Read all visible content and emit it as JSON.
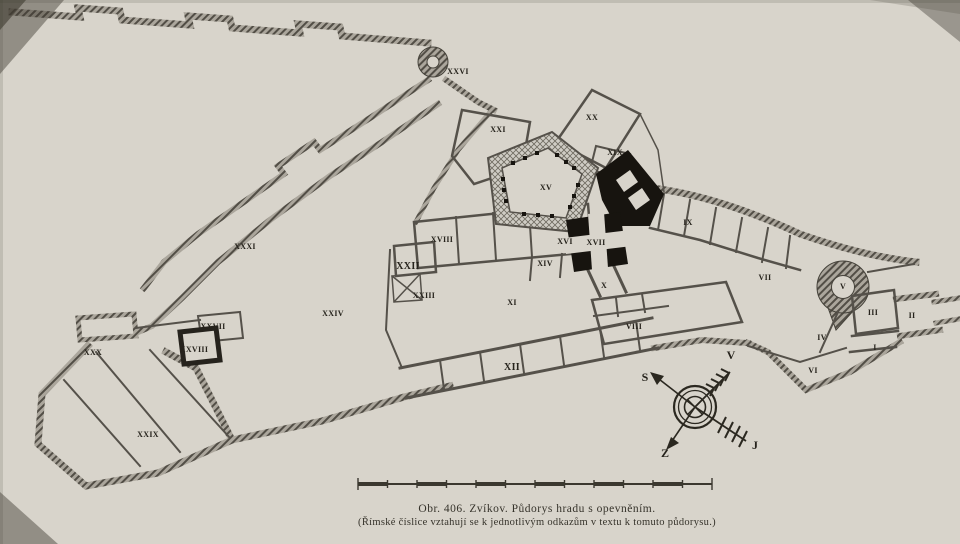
{
  "figure": {
    "caption_line1": "Obr. 406. Zvíkov. Půdorys hradu s opevněním.",
    "caption_line2": "(Římské číslice vztahují se k jednotlivým odkazům v textu k tomuto půdorysu.)"
  },
  "colors": {
    "paper": "#d8d4cb",
    "wall_hatch": "#524e46",
    "wall_thin": "#55514a",
    "solid_black": "#17140f",
    "ink": "#26231c"
  },
  "compass": {
    "points": [
      {
        "text": "S",
        "x": 645,
        "y": 377
      },
      {
        "text": "V",
        "x": 731,
        "y": 355
      },
      {
        "text": "Z",
        "x": 665,
        "y": 453
      },
      {
        "text": "J",
        "x": 755,
        "y": 445
      }
    ]
  },
  "plan": {
    "labels": [
      {
        "text": "I",
        "x": 875,
        "y": 348
      },
      {
        "text": "II",
        "x": 912,
        "y": 316
      },
      {
        "text": "III",
        "x": 873,
        "y": 313
      },
      {
        "text": "IV",
        "x": 822,
        "y": 338
      },
      {
        "text": "V",
        "x": 843,
        "y": 287
      },
      {
        "text": "VI",
        "x": 813,
        "y": 371
      },
      {
        "text": "VII",
        "x": 765,
        "y": 278
      },
      {
        "text": "VIII",
        "x": 634,
        "y": 327
      },
      {
        "text": "IX",
        "x": 688,
        "y": 223
      },
      {
        "text": "X",
        "x": 604,
        "y": 286
      },
      {
        "text": "XI",
        "x": 512,
        "y": 303
      },
      {
        "text": "XII",
        "x": 512,
        "y": 368,
        "bold": true
      },
      {
        "text": "XIV",
        "x": 545,
        "y": 264
      },
      {
        "text": "XV",
        "x": 546,
        "y": 188
      },
      {
        "text": "XVI",
        "x": 565,
        "y": 242
      },
      {
        "text": "XVII",
        "x": 596,
        "y": 243
      },
      {
        "text": "XVIII",
        "x": 442,
        "y": 240
      },
      {
        "text": "XIX",
        "x": 615,
        "y": 153
      },
      {
        "text": "XX",
        "x": 592,
        "y": 118
      },
      {
        "text": "XXI",
        "x": 498,
        "y": 130
      },
      {
        "text": "XXII",
        "x": 408,
        "y": 267,
        "bold": true
      },
      {
        "text": "XXIII",
        "x": 424,
        "y": 296
      },
      {
        "text": "XXIV",
        "x": 333,
        "y": 314
      },
      {
        "text": "XXVI",
        "x": 458,
        "y": 72
      },
      {
        "text": "XXVII",
        "x": 213,
        "y": 327
      },
      {
        "text": "XXVIII",
        "x": 194,
        "y": 350
      },
      {
        "text": "XXIX",
        "x": 148,
        "y": 435
      },
      {
        "text": "XXX",
        "x": 93,
        "y": 353
      },
      {
        "text": "XXXI",
        "x": 245,
        "y": 247
      }
    ]
  }
}
